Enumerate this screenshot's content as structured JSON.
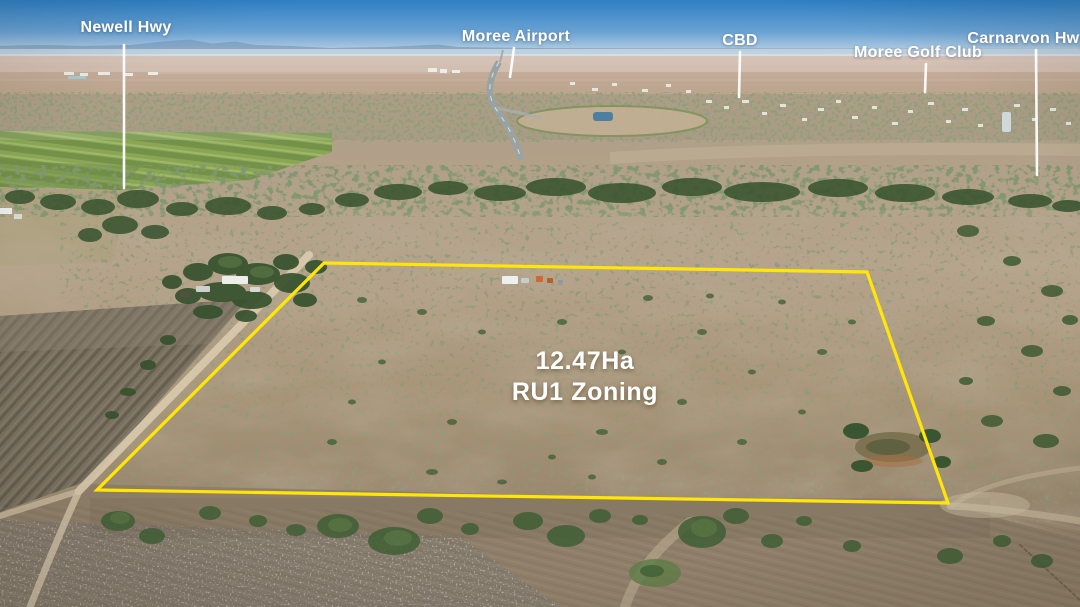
{
  "location_labels": {
    "newell_hwy": "Newell Hwy",
    "moree_airport": "Moree Airport",
    "cbd": "CBD",
    "moree_golf_club": "Moree Golf Club",
    "carnarvon_hwy": "Carnarvon Hwy"
  },
  "property_label": {
    "area": "12.47Ha",
    "zoning": "RU1 Zoning"
  },
  "colors": {
    "boundary_outline": "#FFE606",
    "label_text": "#FFFFFF"
  }
}
